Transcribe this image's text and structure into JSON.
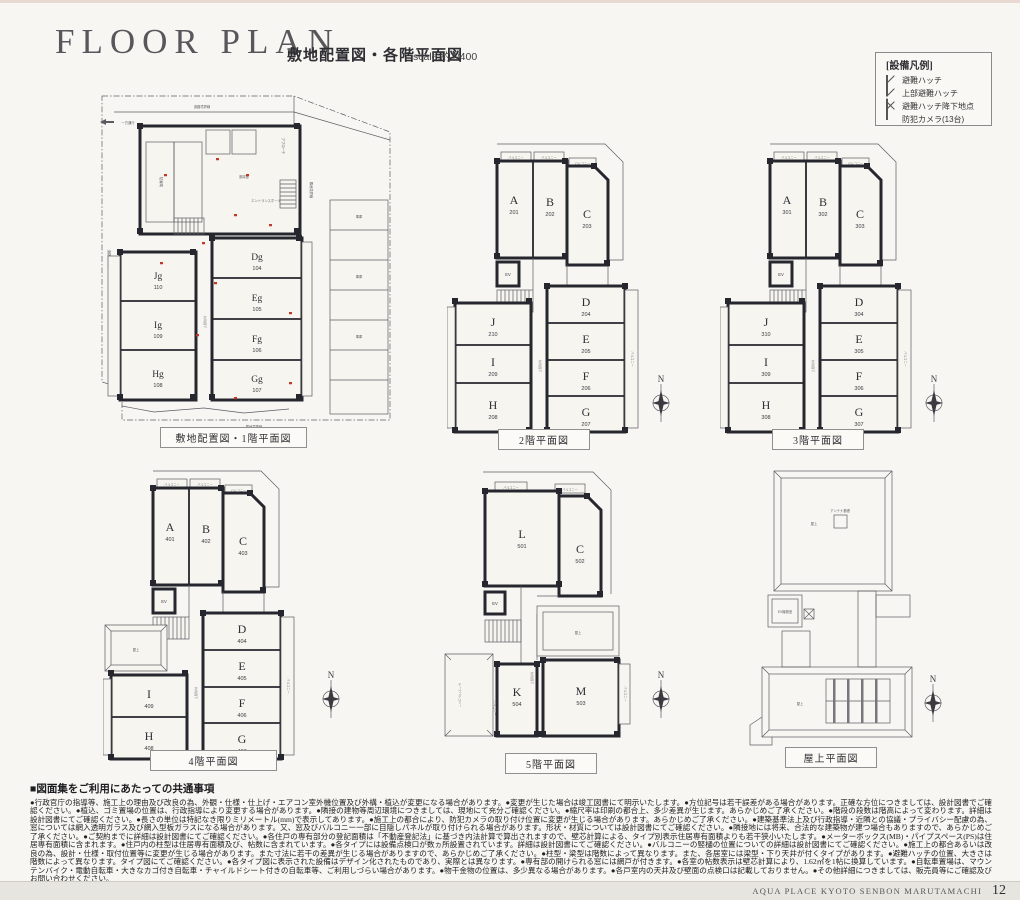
{
  "page": {
    "title": "FLOOR PLAN",
    "subtitle": "敷地配置図・各階平面図",
    "scale": "scale:約1/400",
    "footer_text": "AQUA PLACE KYOTO SENBON MARUTAMACHI",
    "page_number": "12"
  },
  "legend": {
    "title": "[設備凡例]",
    "items": [
      {
        "icon": "hatch-square-diagonal",
        "label": "避難ハッチ"
      },
      {
        "icon": "hatch-square-dashed",
        "label": "上部避難ハッチ"
      },
      {
        "icon": "hatch-square-x",
        "label": "避難ハッチ降下地点"
      },
      {
        "icon": "camera-dot",
        "label": "防犯カメラ(13台)"
      }
    ]
  },
  "labels": {
    "balcony": "バルコニー",
    "roof_balcony": "ルーフバルコニー",
    "corridor": "共用廊下",
    "elevator": "EV",
    "rooftop": "屋上",
    "antenna": "アンテナ基礎",
    "ev_machine": "EV機械室",
    "north": "N"
  },
  "f1_labels": {
    "road_boundary": "道路境界線",
    "adjacent_boundary": "隣地境界線",
    "one_way": "一方通行",
    "approach": "アプローチ",
    "bike_parking": "駐輪場",
    "windbreak": "風除室",
    "entrance_hall": "エントランスホール",
    "garage": "車庫"
  },
  "floors": {
    "f1": {
      "caption": "敷地配置図・1階平面図",
      "rooms": [
        {
          "letter": "Dg",
          "no": "104"
        },
        {
          "letter": "Eg",
          "no": "105"
        },
        {
          "letter": "Fg",
          "no": "106"
        },
        {
          "letter": "Gg",
          "no": "107"
        },
        {
          "letter": "Hg",
          "no": "108"
        },
        {
          "letter": "Ig",
          "no": "109"
        },
        {
          "letter": "Jg",
          "no": "110"
        }
      ]
    },
    "f2": {
      "caption": "2階平面図",
      "rooms": [
        {
          "letter": "A",
          "no": "201"
        },
        {
          "letter": "B",
          "no": "202"
        },
        {
          "letter": "C",
          "no": "203"
        },
        {
          "letter": "D",
          "no": "204"
        },
        {
          "letter": "E",
          "no": "205"
        },
        {
          "letter": "F",
          "no": "206"
        },
        {
          "letter": "G",
          "no": "207"
        },
        {
          "letter": "H",
          "no": "208"
        },
        {
          "letter": "I",
          "no": "209"
        },
        {
          "letter": "J",
          "no": "210"
        }
      ]
    },
    "f3": {
      "caption": "3階平面図",
      "rooms": [
        {
          "letter": "A",
          "no": "301"
        },
        {
          "letter": "B",
          "no": "302"
        },
        {
          "letter": "C",
          "no": "303"
        },
        {
          "letter": "D",
          "no": "304"
        },
        {
          "letter": "E",
          "no": "305"
        },
        {
          "letter": "F",
          "no": "306"
        },
        {
          "letter": "G",
          "no": "307"
        },
        {
          "letter": "H",
          "no": "308"
        },
        {
          "letter": "I",
          "no": "309"
        },
        {
          "letter": "J",
          "no": "310"
        }
      ]
    },
    "f4": {
      "caption": "4階平面図",
      "rooms": [
        {
          "letter": "A",
          "no": "401"
        },
        {
          "letter": "B",
          "no": "402"
        },
        {
          "letter": "C",
          "no": "403"
        },
        {
          "letter": "D",
          "no": "404"
        },
        {
          "letter": "E",
          "no": "405"
        },
        {
          "letter": "F",
          "no": "406"
        },
        {
          "letter": "G",
          "no": "407"
        },
        {
          "letter": "H",
          "no": "408"
        },
        {
          "letter": "I",
          "no": "409"
        }
      ]
    },
    "f5": {
      "caption": "5階平面図",
      "rooms": [
        {
          "letter": "L",
          "no": "501"
        },
        {
          "letter": "C",
          "no": "502"
        },
        {
          "letter": "M",
          "no": "503"
        },
        {
          "letter": "K",
          "no": "504"
        }
      ]
    },
    "roof": {
      "caption": "屋上平面図"
    }
  },
  "notes": {
    "heading": "■図面集をご利用にあたっての共通事項",
    "body": "●行政官庁の指導等、施工上の理由及び改良の為、外観・仕様・仕上げ・エアコン室外機位置及び外構・植込が変更になる場合があります。●変更が生じた場合は竣工図書にて明示いたします。●方位記号は若干誤差がある場合があります。正確な方位につきましては、設計図書でご確認ください。●植込、ゴミ置場の位置は、行政指導により変更する場合があります。●隣接の建物等周辺環境につきましては、現地にて充分ご確認ください。●縮尺率は印刷の都合上、多少差異が生じます。あらかじめご了承ください。●階段の段数は階高によって変わります。詳細は設計図書にてご確認ください。●長さの単位は特記なき限りミリメートル(mm)で表示してあります。●施工上の都合により、防犯カメラの取り付け位置に変更が生じる場合があります。あらかじめご了承ください。●建築基準法上及び行政指導・近隣との協議・プライバシー配慮の為、窓については網入透明ガラス及び網入型板ガラスになる場合があります。又、窓及びバルコニー一部に目隠しパネルが取り付けられる場合があります。形状・材質については設計図書にてご確認ください。●隣接地には将来、合法的な建築物が建つ場合もありますので、あらかじめご了承ください。●ご契約までに詳細は設計図書にてご確認ください。●各住戸の専有部分の登記面積は「不動産登記法」に基づき内法計算で算出されますので、壁芯計算による、タイプ別表示住居専有面積よりも若干狭小いたします。●メーターボックス(MB)・パイプスペース(PS)は住居専有面積に含まれます。●住戸内の柱型は住居専有面積及び、帖数に含まれています。●各タイプには設備点検口が数ヵ所設置されています。詳細は設計図書にてご確認ください。●バルコニーの竪樋の位置についての詳細は設計図書にてご確認ください。●施工上の都合あるいは改良の為、設計・仕様・取付位置等に変更が生じる場合があります。また寸法に若干の差異が生じる場合がありますので、あらかじめご了承ください。●柱型・梁型は階数によって異なります。また、各居室には梁型・下り天井が付くタイプがあります。●避難ハッチの位置、大きさは階数によって異なります。タイプ図にてご確認ください。●各タイプ図に表示された設備はデザイン化されたものであり、実際とは異なります。●専有部の開けられる窓には網戸が付きます。●各室の帖数表示は壁芯計算により、1.62㎡を1帖に換算しています。●自転車置場は、マウンテンバイク・電動自転車・大きなカゴ付き自転車・チャイルドシート付きの自転車等、ご利用しづらい場合があります。●物干金物の位置は、多少異なる場合があります。●各戸室内の天井及び壁面の点検口は記載しておりません。●その他詳細につきましては、販売員等にご確認及びお問い合わせください。"
  },
  "colors": {
    "camera_red": "#c0392b",
    "wall": "#26262e",
    "footer_band": "#e7e5e0"
  }
}
